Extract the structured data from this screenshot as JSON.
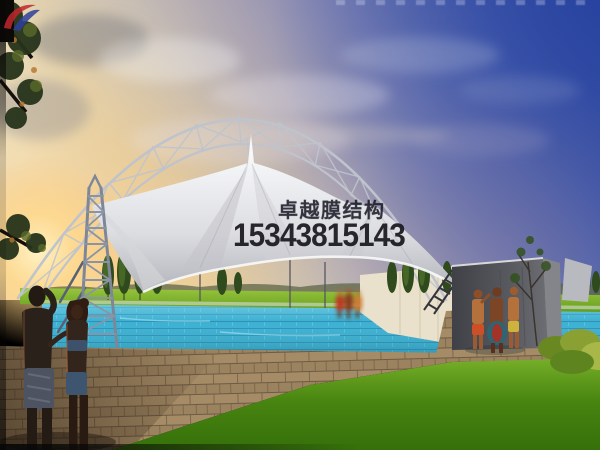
{
  "watermark": {
    "brand_text": "卓越膜结构",
    "phone_number": "15343815143",
    "logo_red": "#c0272d",
    "logo_blue": "#2b3f9c",
    "text_color": "#16161e"
  },
  "scene": {
    "subject": "Tensile membrane canopy with steel arch truss over an outdoor swimming pool at sunset",
    "palette": {
      "sky_deep_blue": "#2e49a0",
      "sunset_glow": "#f5c26a",
      "membrane_white": "#eef0f2",
      "pool_turquoise": "#3db0d2",
      "deck_tan": "#a58c66",
      "grass_green": "#4e8c12",
      "end_wall_grey": "#54555b",
      "truss_grey": "#bfc3cc"
    }
  }
}
